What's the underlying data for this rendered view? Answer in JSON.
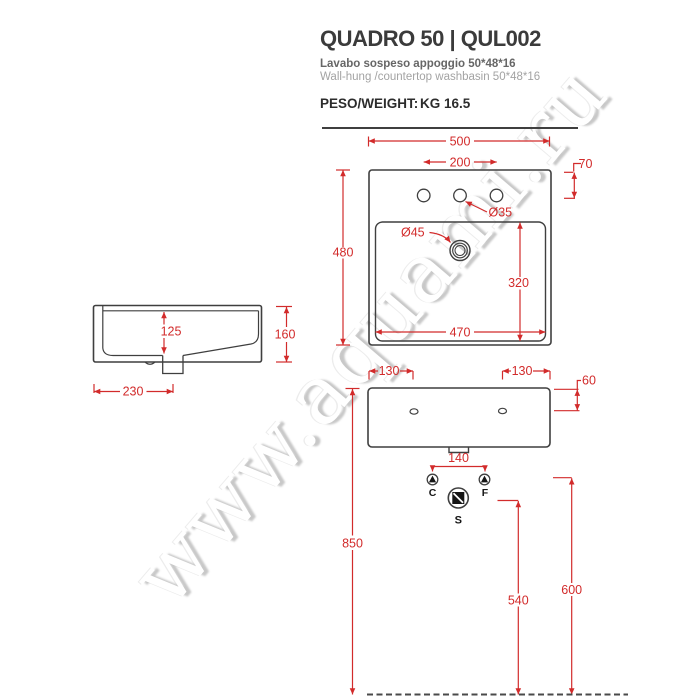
{
  "header": {
    "title": "QUADRO 50 | QUL002",
    "subtitle_it": "Lavabo  sospeso appoggio 50*48*16",
    "subtitle_en": "Wall-hung /countertop washbasin 50*48*16",
    "weight_label": "PESO/WEIGHT:",
    "weight_value": "KG 16.5"
  },
  "watermark": "www.aquami.ru",
  "colors": {
    "dimension_red": "#d22b2b",
    "drawing_gray": "#3f3f3f"
  },
  "drawing": {
    "top_view": {
      "overall_width": "500",
      "faucet_holes_span": "200",
      "faucet_holes_offset": "70",
      "overall_depth": "480",
      "faucet_hole_diameter": "Ø35",
      "drain_diameter": "Ø45",
      "basin_inner_depth": "320",
      "basin_inner_width": "470"
    },
    "side_view": {
      "basin_inner_height": "125",
      "overall_height": "160",
      "drain_offset_from_wall": "230"
    },
    "front_view": {
      "left_hole_offset": "130",
      "right_hole_offset": "130",
      "hole_top_offset": "60",
      "supply_span": "140",
      "rim_height_from_floor": "850",
      "drain_height_from_floor": "540",
      "supply_height_from_floor": "600",
      "symbol_cold": "C",
      "symbol_hot": "F",
      "symbol_drain": "S"
    }
  }
}
